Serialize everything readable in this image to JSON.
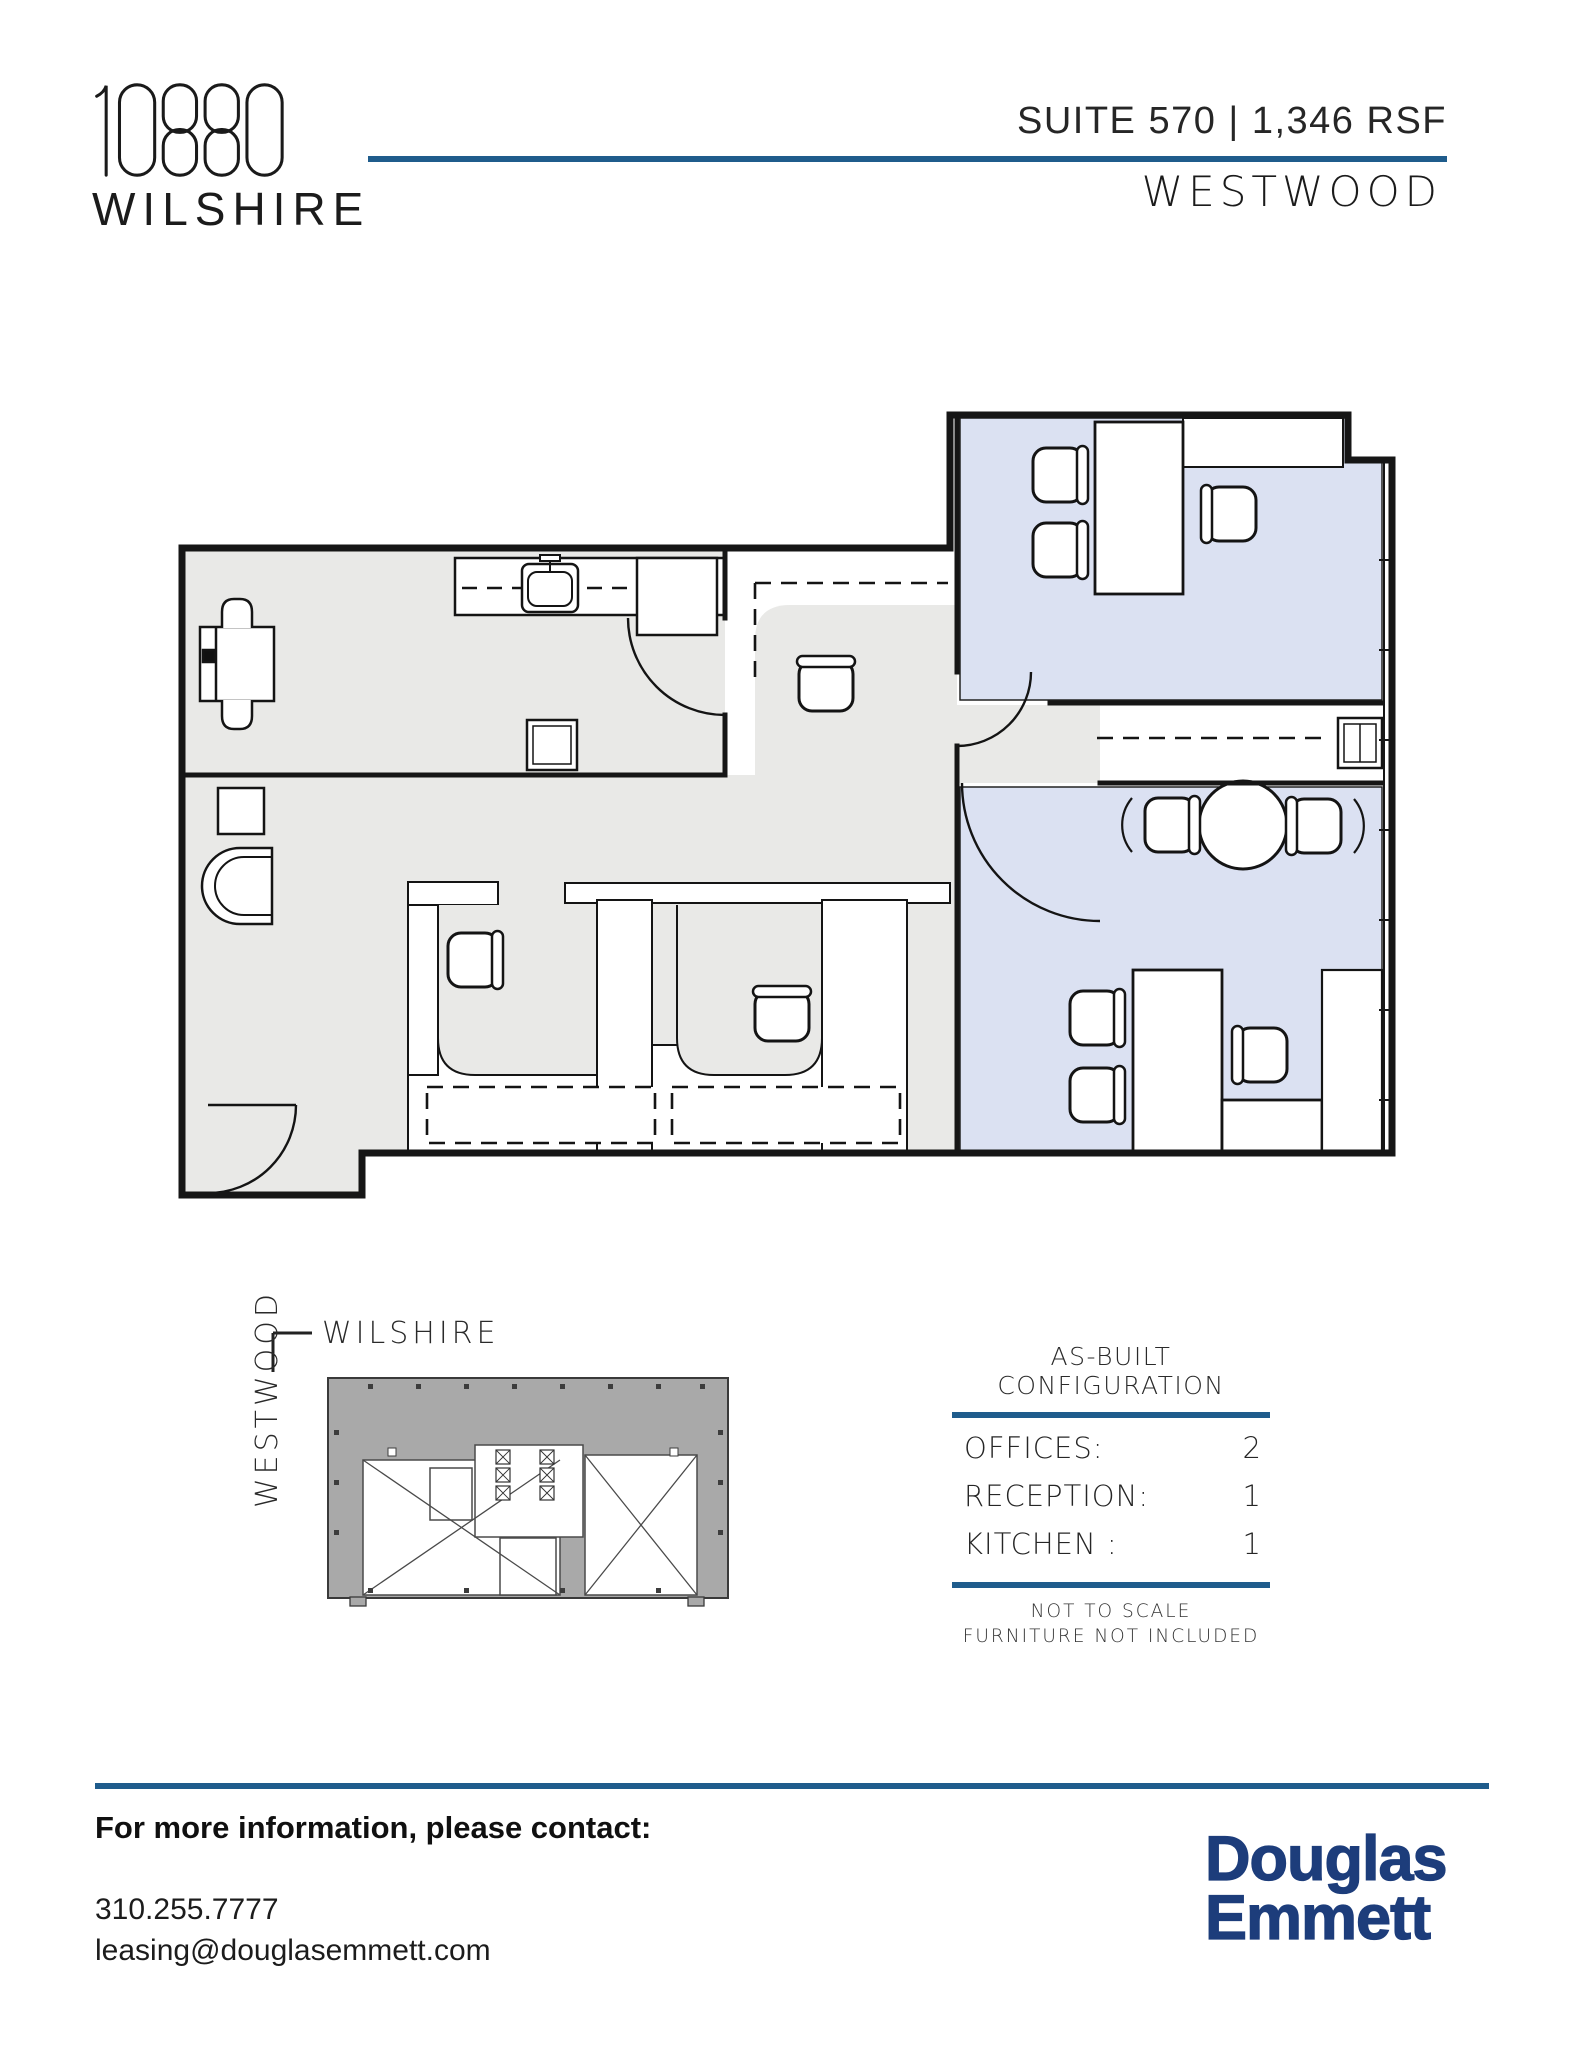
{
  "header": {
    "building_number": "10880",
    "building_name": "WILSHIRE",
    "suite_line": "SUITE 570 | 1,346 RSF",
    "submarket": "WESTWOOD"
  },
  "keyplan": {
    "street_top": "WILSHIRE",
    "street_left": "WESTWOOD"
  },
  "config": {
    "title": "AS-BUILT CONFIGURATION",
    "rows": [
      {
        "label": "OFFICES:",
        "value": "2"
      },
      {
        "label": "RECEPTION:",
        "value": "1"
      },
      {
        "label": "KITCHEN :",
        "value": "1"
      }
    ],
    "note1": "NOT TO SCALE",
    "note2": "FURNITURE NOT INCLUDED"
  },
  "footer": {
    "contact_heading": "For more information, please contact:",
    "phone": "310.255.7777",
    "email": "leasing@douglasemmett.com",
    "logo_line1": "Douglas",
    "logo_line2": "Emmett"
  },
  "colors": {
    "accent_blue": "#1f5c8c",
    "logo_navy": "#1d3d7b",
    "floor_grey": "#e9e9e7",
    "room_blue": "#dbe1f2",
    "keyplan_grey": "#a9a9a9",
    "wall_black": "#161616"
  }
}
